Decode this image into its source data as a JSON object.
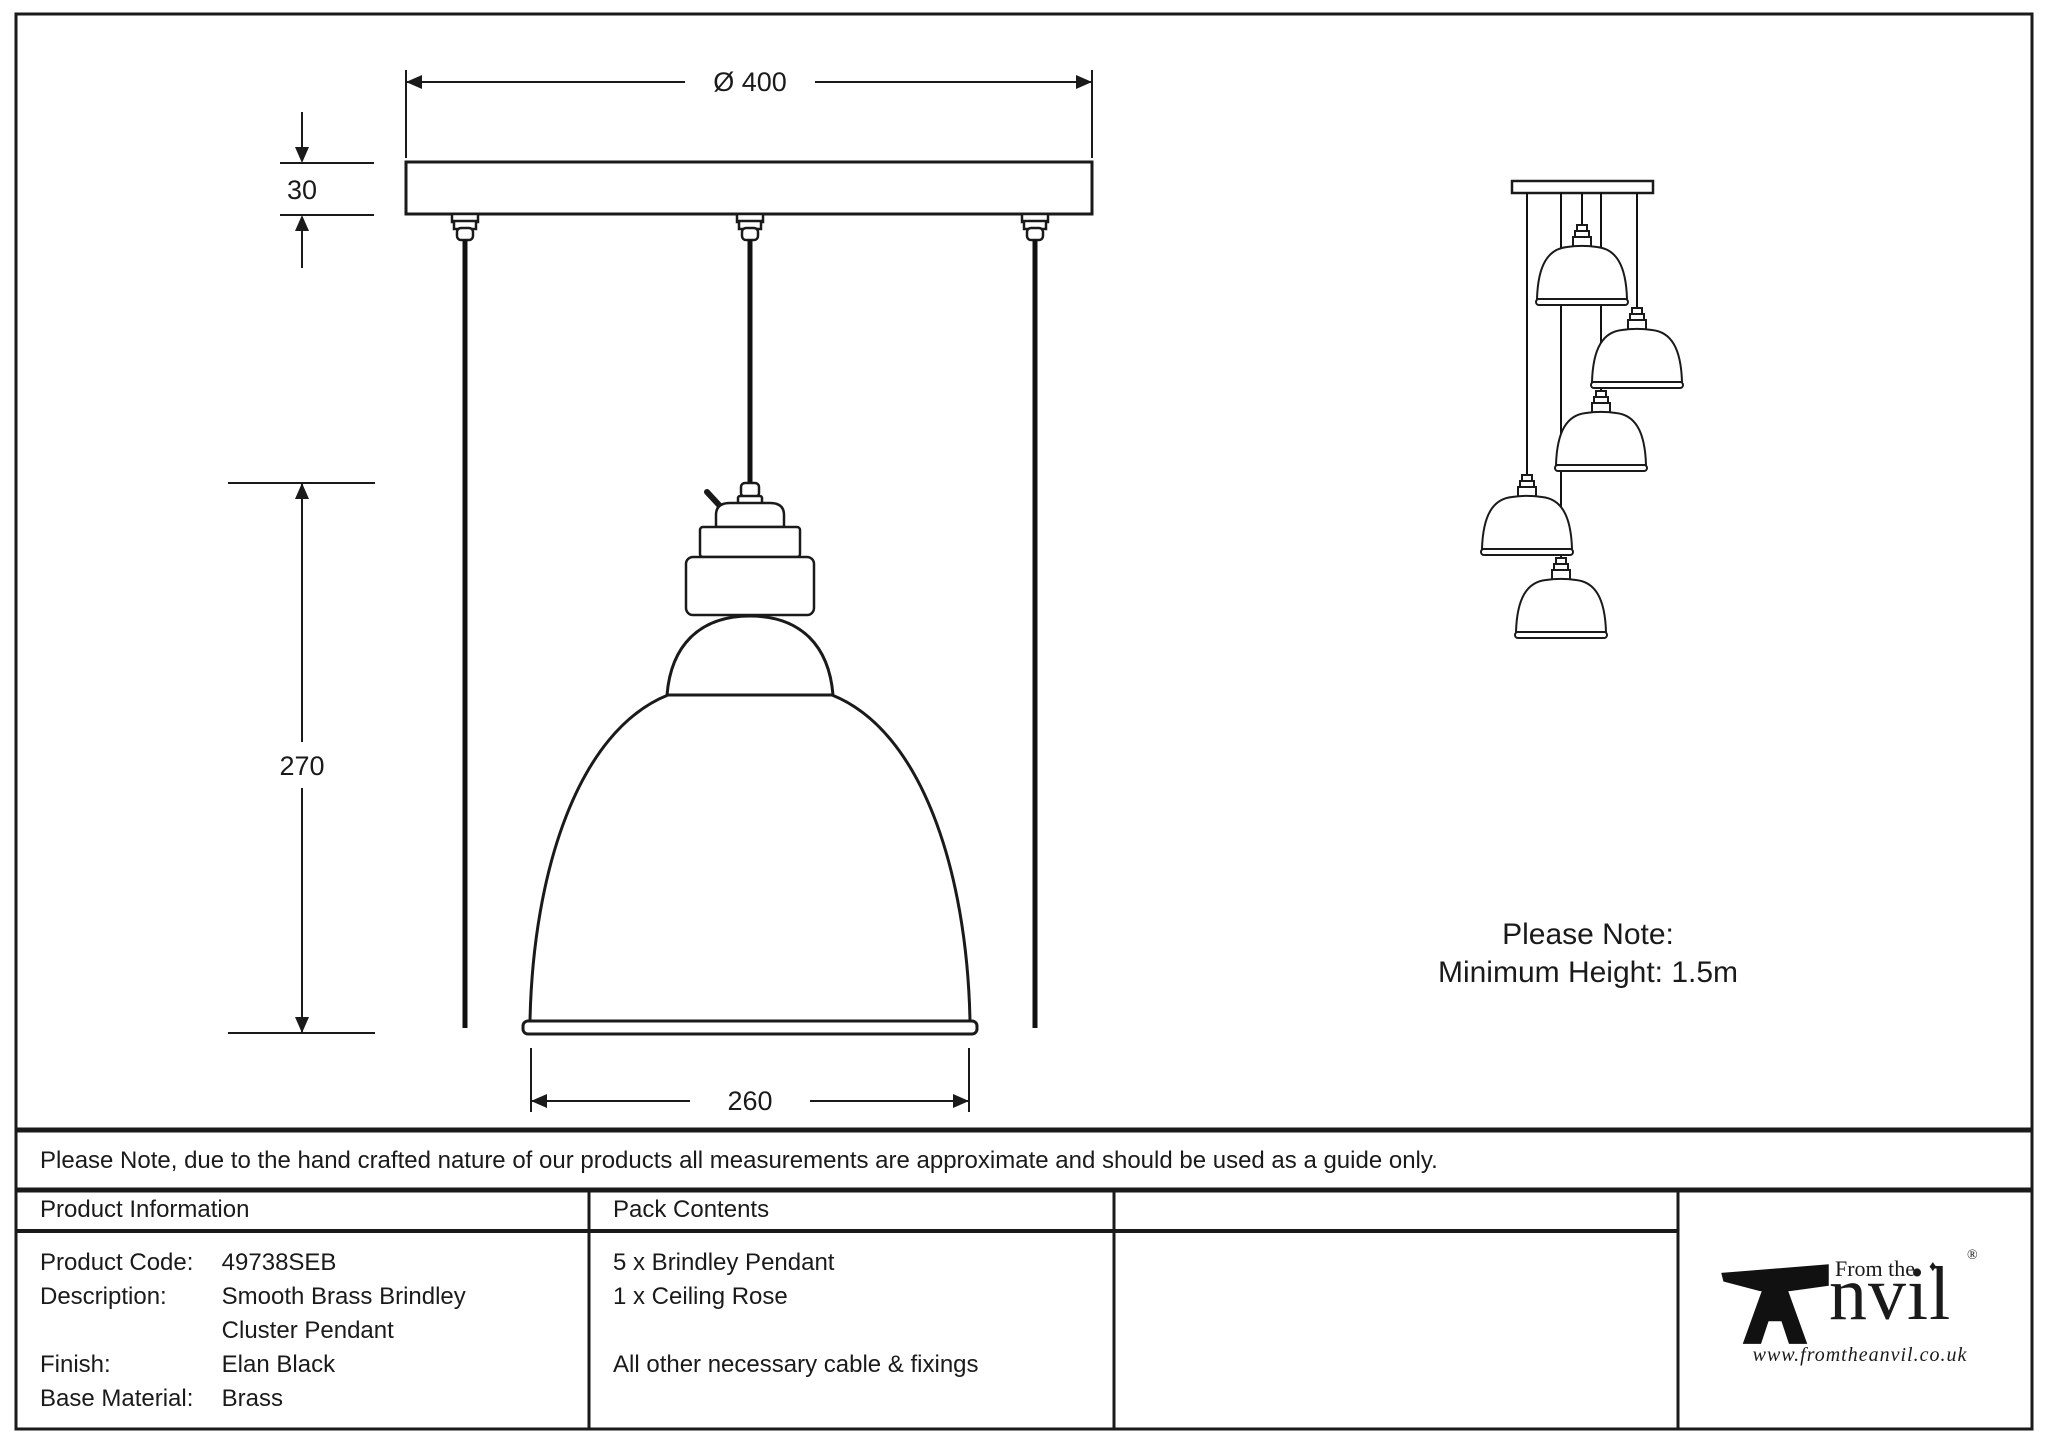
{
  "drawing": {
    "dim_diameter": "Ø 400",
    "dim_rose_thickness": "30",
    "dim_pendant_height": "270",
    "dim_shade_diameter": "260",
    "cluster_note_title": "Please Note:",
    "cluster_note_body": "Minimum Height: 1.5m"
  },
  "disclaimer": "Please Note, due to the hand crafted nature of our products all measurements are approximate and should be used as a guide only.",
  "product_info": {
    "header": "Product Information",
    "rows": [
      {
        "label": "Product Code:",
        "value": "49738SEB"
      },
      {
        "label": "Description:",
        "value": "Smooth Brass Brindley"
      },
      {
        "label": "",
        "value": "Cluster Pendant"
      },
      {
        "label": "Finish:",
        "value": "Elan Black"
      },
      {
        "label": "Base Material:",
        "value": "Brass"
      }
    ]
  },
  "pack_contents": {
    "header": "Pack Contents",
    "lines": [
      "5 x Brindley Pendant",
      "1 x Ceiling Rose",
      "",
      "All other necessary cable & fixings"
    ]
  },
  "logo": {
    "from_the": "From the",
    "diamond": "♦",
    "registered": "®",
    "name_rest": "nvil",
    "url": "www.fromtheanvil.co.uk"
  },
  "colors": {
    "ink": "#1a1a1a"
  }
}
